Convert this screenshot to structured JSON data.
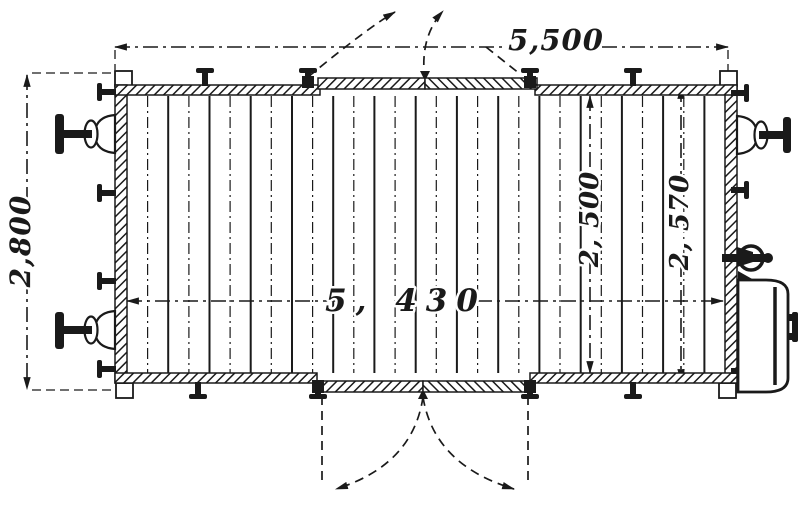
{
  "figure": {
    "type": "engineering-line-drawing",
    "subject": "Covered goods wagon — floor plan (top view)",
    "ink_color": "#1a1a1a",
    "paper_color": "#ffffff"
  },
  "dimensions": {
    "overall_length": {
      "label": "5,500",
      "placement": "top edge, horizontal dash-dot line"
    },
    "overall_width": {
      "label": "2,800",
      "placement": "left edge, vertical dash-dot line"
    },
    "interior_length": {
      "label": "5, 430",
      "placement": "horizontal centre line across floor"
    },
    "interior_width": {
      "label": "2, 500",
      "placement": "vertical line inside body, right of centre"
    },
    "width_over_walls": {
      "label": "2, 570",
      "placement": "vertical line inside body, far right of centre"
    }
  },
  "components": [
    "hatched body walls",
    "sliding side doors top and bottom centre with dashed opening swing arcs",
    "planked floor boards (alternating solid and dash-dot lines)",
    "two side buffers on the left end",
    "one side buffer on the right end",
    "coupling gear with link ring at bottom right",
    "wall bolts / cleats around the frame",
    "corner posts at the four corners"
  ]
}
